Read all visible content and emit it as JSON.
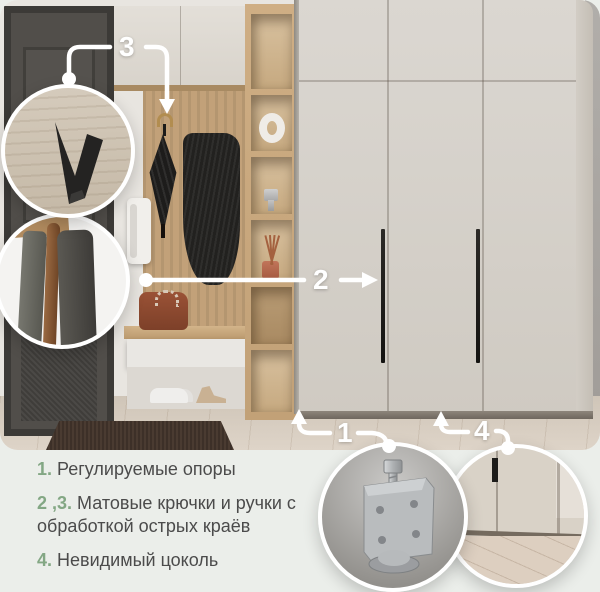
{
  "page": {
    "background_color": "#ebeeea",
    "accent_green": "#83a784",
    "text_color": "#4b4b4b",
    "callout_color": "#ffffff"
  },
  "callouts": [
    {
      "label": "1",
      "points_to": "adjustable-supports-under-cabinet"
    },
    {
      "label": "2",
      "points_to": "wardrobe-door-handle"
    },
    {
      "label": "3",
      "points_to": "wall-hook-with-umbrella"
    },
    {
      "label": "4",
      "points_to": "wardrobe-invisible-plinth"
    }
  ],
  "features": [
    {
      "num": "1.",
      "text": "Регулируемые опоры"
    },
    {
      "num": "2 ,3.",
      "text": "Матовые крючки и ручки с обработкой острых краёв"
    },
    {
      "num": "4.",
      "text": "Невидимый цоколь"
    }
  ],
  "insets": [
    {
      "name": "hook-detail"
    },
    {
      "name": "panel-edge-detail"
    },
    {
      "name": "adjustable-foot-detail"
    },
    {
      "name": "plinth-detail"
    }
  ]
}
